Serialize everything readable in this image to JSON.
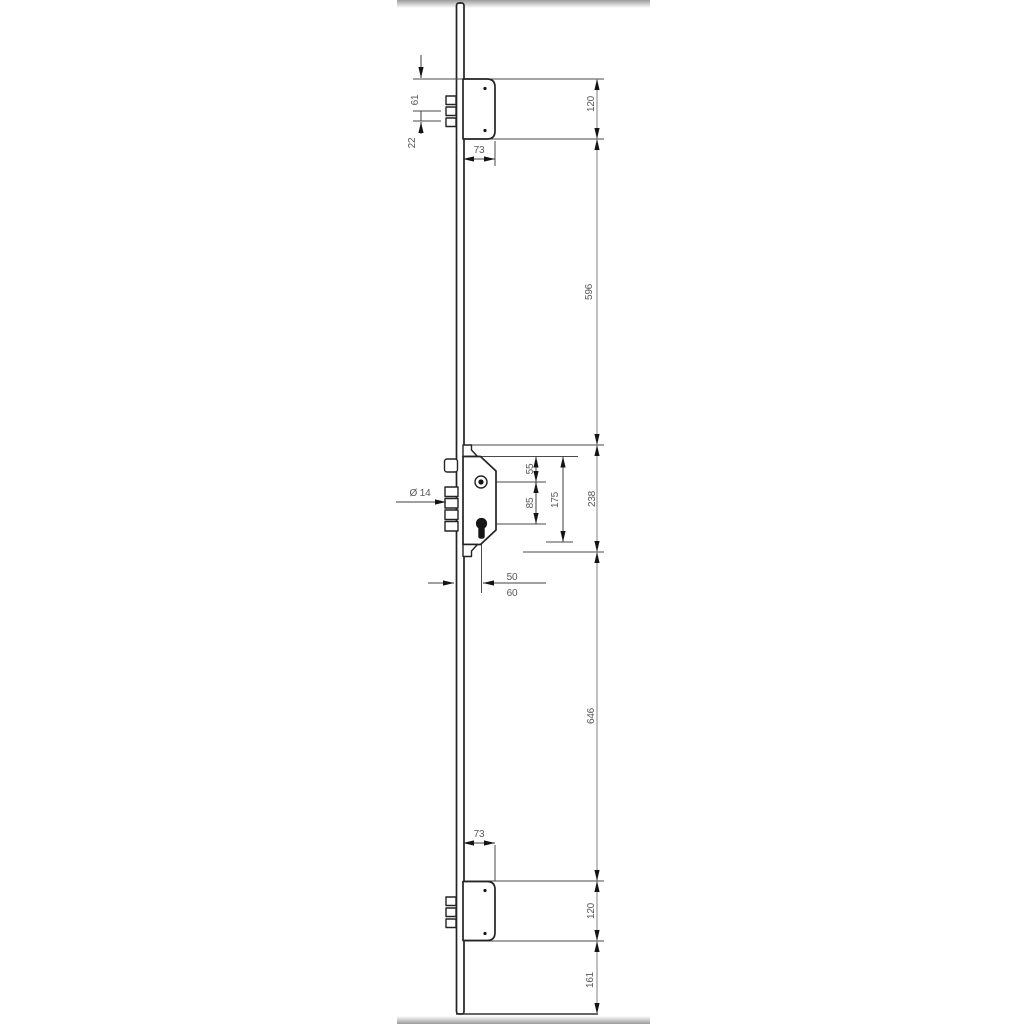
{
  "drawing": {
    "description": "multipoint-lock-technical-drawing",
    "labels": {
      "dim_61": "61",
      "dim_22": "22",
      "dim_73_top": "73",
      "dim_120_top": "120",
      "dim_596": "596",
      "dim_238": "238",
      "dim_55": "55",
      "dim_85": "85",
      "dim_175": "175",
      "dim_diameter_14": "Ø 14",
      "dim_50": "50",
      "dim_60": "60",
      "dim_646": "646",
      "dim_73_bottom": "73",
      "dim_120_bottom": "120",
      "dim_161": "161"
    },
    "colors": {
      "outline": "#232323",
      "dimension_line": "#3f3f3f",
      "chain_line": "#8c8c8c",
      "arrowhead": "#141414",
      "label_text": "#585858",
      "edge_bar": "#9b9b9b",
      "background": "#ffffff"
    }
  }
}
